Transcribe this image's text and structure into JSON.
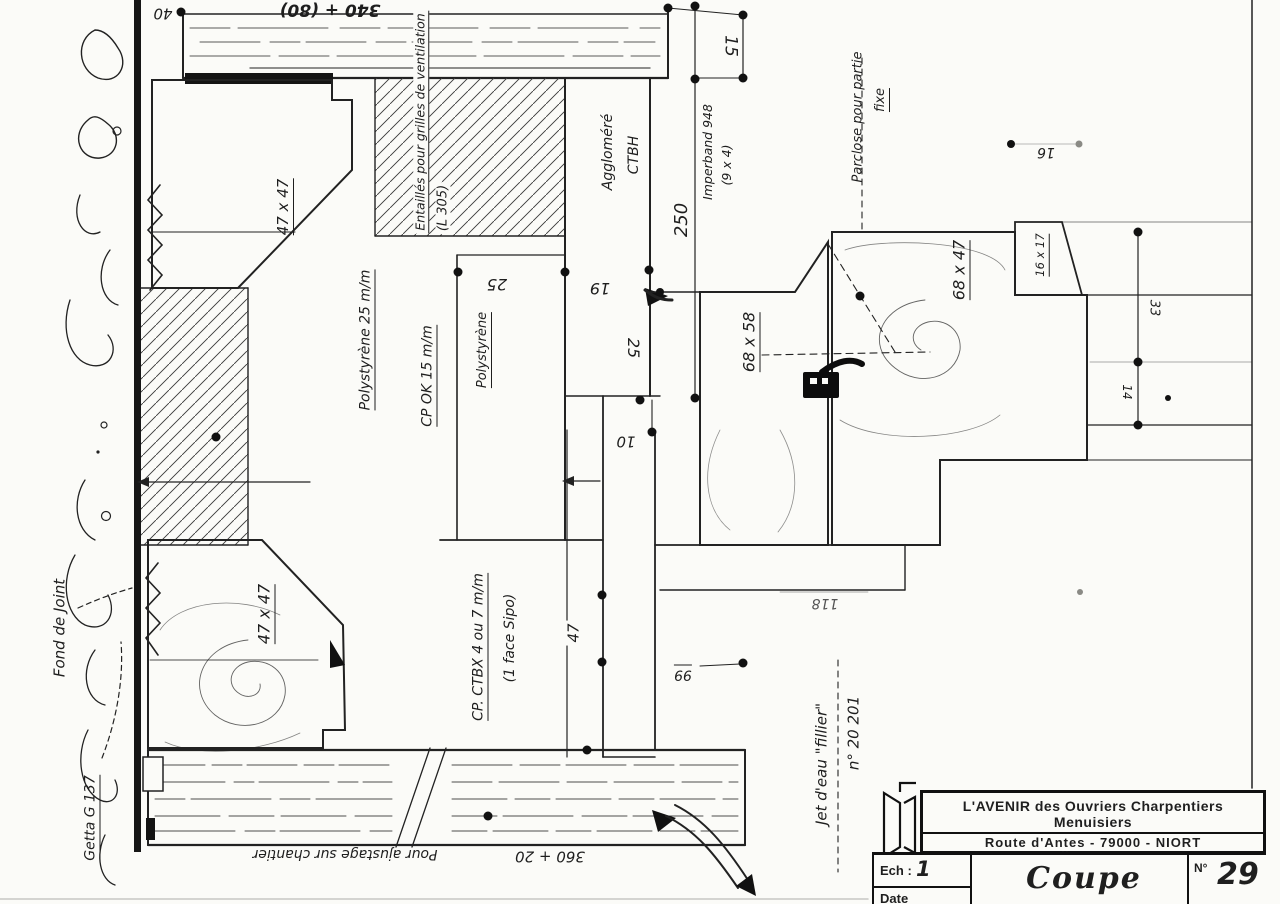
{
  "labels": {
    "dim_340_80": "340 + (80)",
    "dim_40": "40",
    "dim_15": "15",
    "dim_250": "250",
    "dim_10": "10",
    "dim_25_left": "25",
    "dim_19": "19",
    "dim_25_right": "25",
    "dim_16_top": "16",
    "dim_33": "33",
    "dim_14": "14",
    "dim_47": "47",
    "dim_99": "99",
    "dim_118": "118",
    "dim_360_20": "360 + 20",
    "size_47x47_top": "47 x 47",
    "size_47x47_bottom": "47 x 47",
    "size_68x58": "68 x 58",
    "size_68x47": "68 x 47",
    "size_16x17": "16 x 17",
    "entailles_1": "Entaillés pour grilles de ventilation",
    "entailles_2": "(L 305)",
    "agglomere_1": "Aggloméré",
    "agglomere_2": "CTBH",
    "imperband_1": "Imperband 948",
    "imperband_2": "(9 x 4)",
    "parclose_1": "Parclose pour partie",
    "parclose_2": "fixe",
    "polystyrene_25": "Polystyrène 25 m/m",
    "cp_ok": "CP OK 15 m/m",
    "polystyrene": "Polystyrène",
    "fond_de_joint": "Fond de Joint",
    "getta": "Getta G 137",
    "cp_ctbx_1": "CP. CTBX 4 ou 7 m/m",
    "cp_ctbx_2": "(1 face Sipo)",
    "ajustage": "Pour ajustage sur chantier",
    "jet_deau": "Jet d'eau \"fillier\"",
    "numero": "n° 20 201"
  },
  "title_block": {
    "company": "L'AVENIR  des Ouvriers Charpentiers Menuisiers",
    "address": "Route d'Antes - 79000 - NIORT",
    "phone": "tél. : 28.36.44",
    "scale_label": "Ech :",
    "scale_value": "1",
    "date_label": "Date",
    "title": "Coupe",
    "number_label": "N°",
    "number": "29"
  },
  "colors": {
    "ink": "#1f1f1f",
    "paper": "#fbfbf8"
  }
}
